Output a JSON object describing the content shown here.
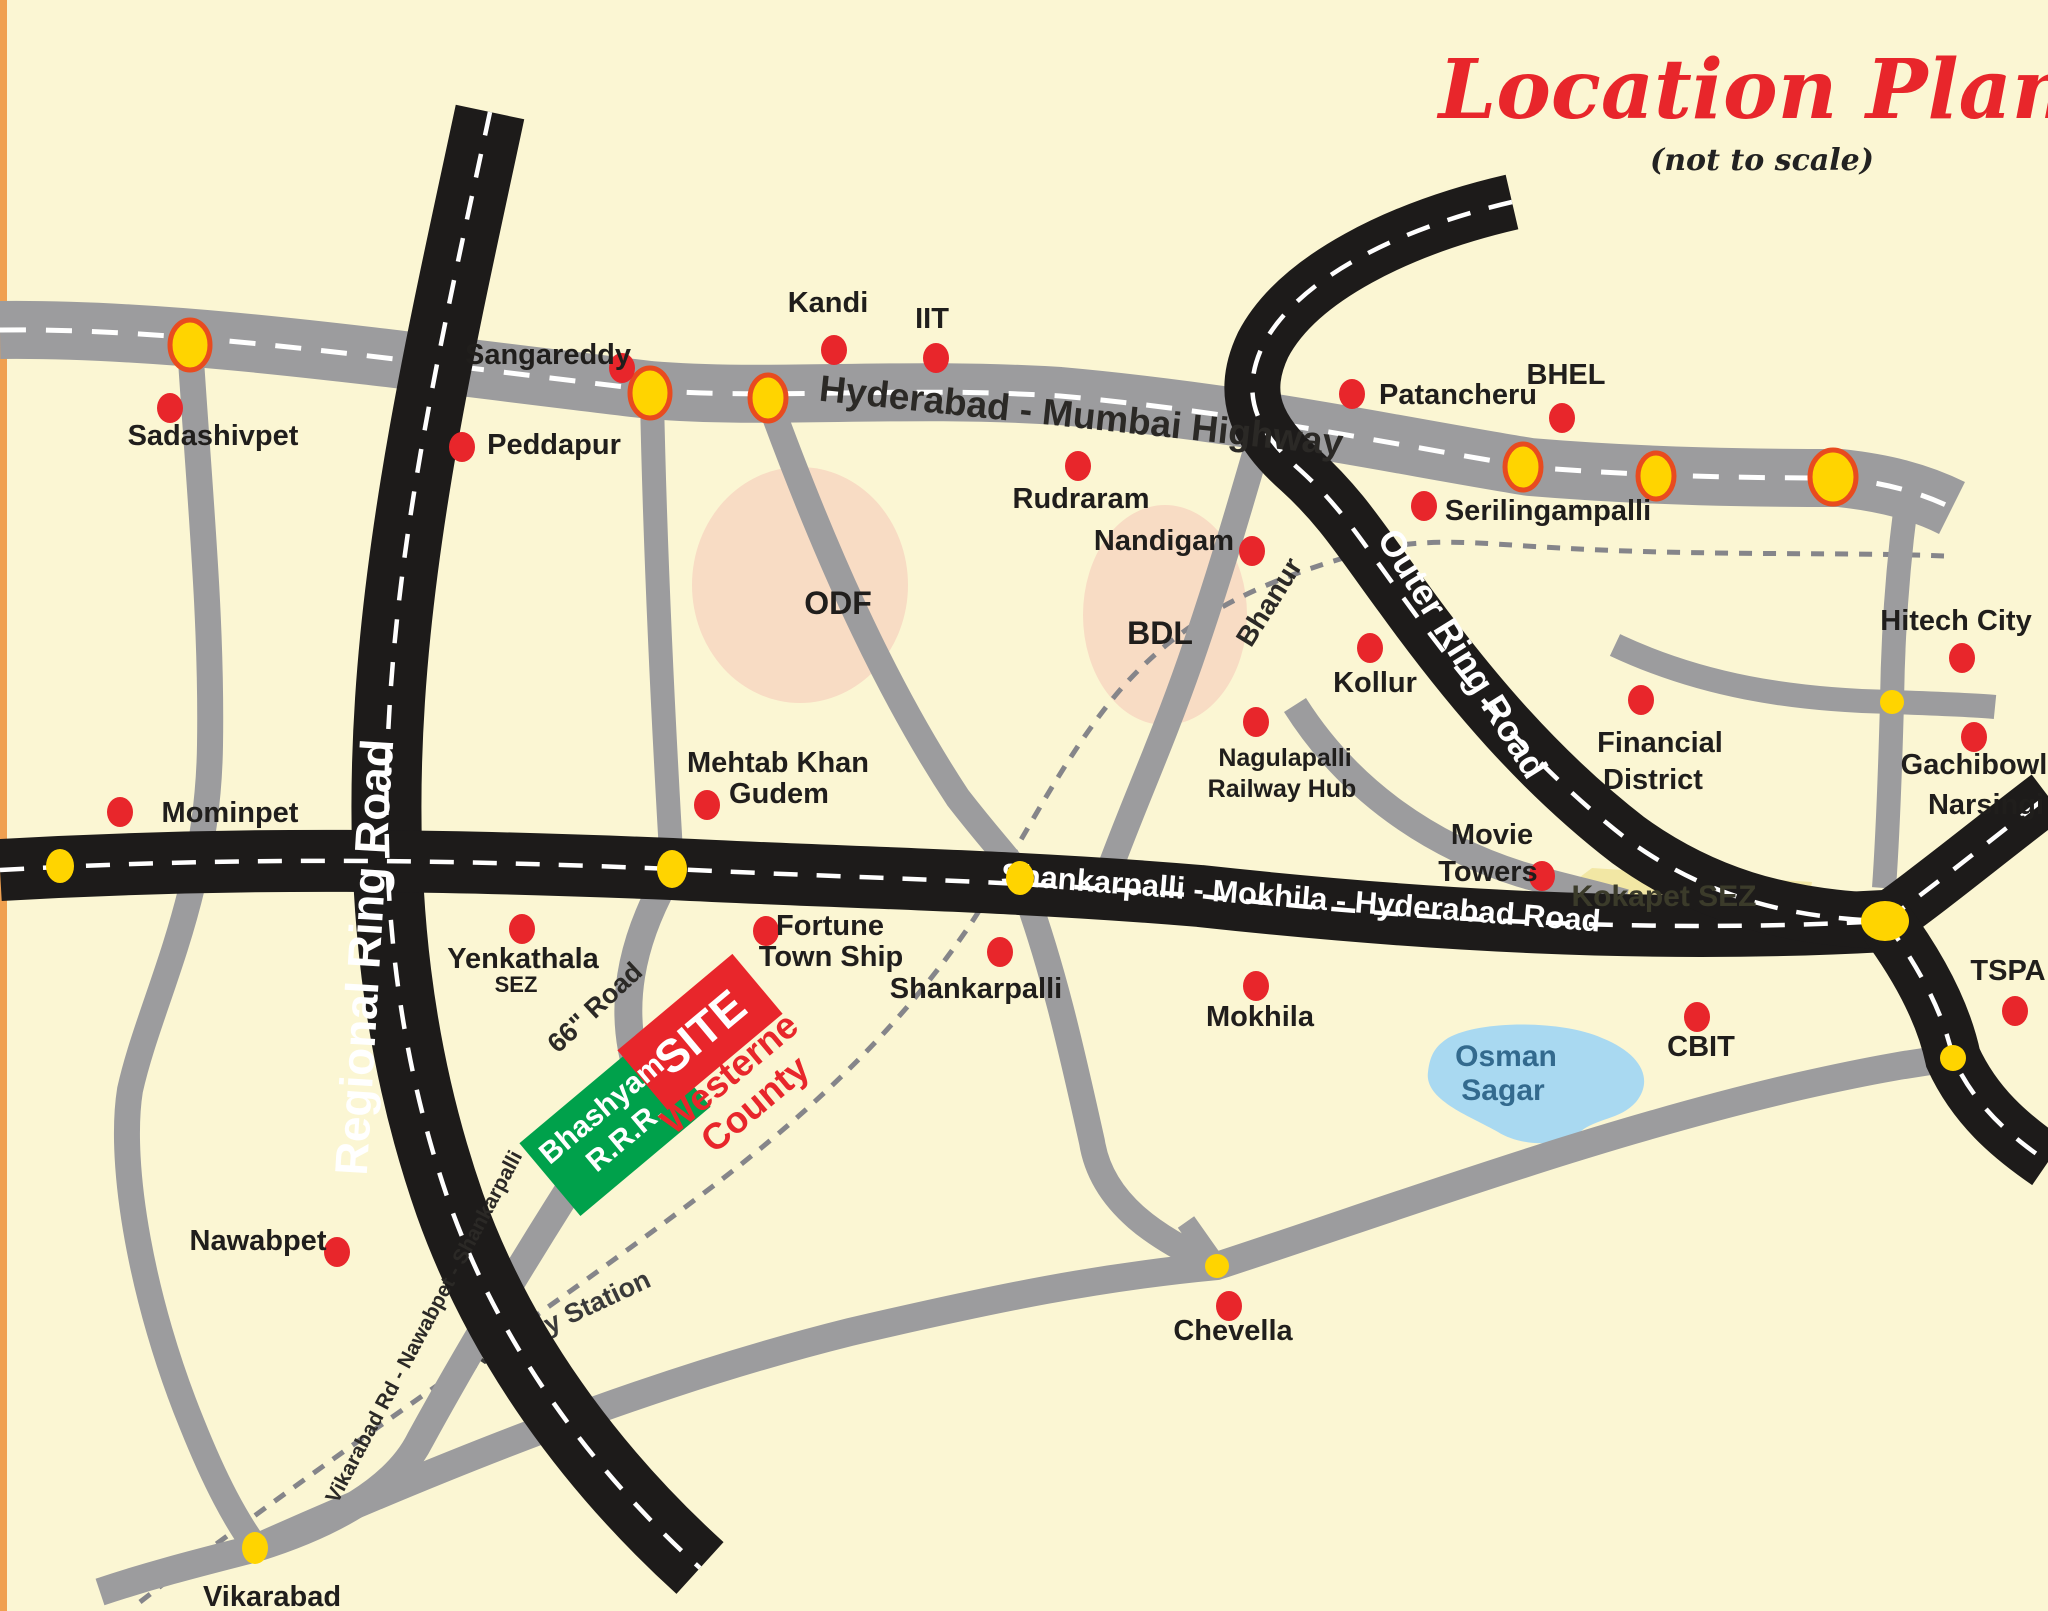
{
  "title": {
    "text": "Location Plan",
    "subtitle": "(not to scale)"
  },
  "colors": {
    "background": "#fbf6d3",
    "left_border": "#f0a050",
    "road_gray": "#9c9c9e",
    "road_black": "#1d1b1a",
    "centerline_dash": "#ffffff",
    "railway_dash": "#85858a",
    "town_dot_red": "#e8262b",
    "junction_yellow": "#ffd400",
    "junction_ring_red": "#e84b1f",
    "factory_zone_pink": "#f8dcc4",
    "kokapet_sez_yellow": "#f2e7a4",
    "lake_blue": "#a9d9f1",
    "lake_text": "#336a8e",
    "site_green": "#00a14b",
    "site_red": "#e8262b",
    "title_red": "#e8262b",
    "label_black": "#201e1c"
  },
  "road_labels": [
    {
      "id": "hyderabad-mumbai-highway",
      "text": "Hyderabad - Mumbai Highway",
      "x": 1080,
      "y": 428,
      "rot": 6,
      "size": 37,
      "color": "#2b2926",
      "layer": "over"
    },
    {
      "id": "regional-ring-road",
      "text": "Regional Ring Road",
      "x": 380,
      "y": 958,
      "rot": -86.5,
      "size": 46,
      "color": "#ffffff",
      "layer": "over"
    },
    {
      "id": "outer-ring-road",
      "text": "Outer Ring Road",
      "x": 1452,
      "y": 660,
      "rot": 58,
      "size": 36,
      "color": "#ffffff",
      "layer": "over"
    },
    {
      "id": "shankarpalli-mokhila-hyderabad-road",
      "text": "Shankarpalli - Mokhila - Hyderabad Road",
      "x": 1300,
      "y": 908,
      "rot": 4.5,
      "size": 31,
      "color": "#ffffff",
      "layer": "over"
    },
    {
      "id": "sixtysix-road",
      "text": "66\" Road",
      "x": 601,
      "y": 1014,
      "rot": -43,
      "size": 27,
      "color": "#2b2926",
      "layer": "over"
    },
    {
      "id": "vikarabad-road",
      "text": "Vikarabad Rd - Nawabpet - Shankarpalli",
      "x": 430,
      "y": 1330,
      "rot": -62,
      "size": 21,
      "color": "#2b2926",
      "layer": "over"
    },
    {
      "id": "railway-station",
      "text": "Railway Station",
      "x": 562,
      "y": 1328,
      "rot": -25,
      "size": 27,
      "color": "#3a3a3a",
      "layer": "under"
    },
    {
      "id": "bhanur",
      "text": "Bhanur",
      "x": 1277,
      "y": 607,
      "rot": -58,
      "size": 28,
      "color": "#2b2926",
      "layer": "over"
    }
  ],
  "towns": [
    {
      "id": "sadashivpet",
      "dot": [
        170,
        408
      ],
      "lines": [
        [
          "Sadashivpet",
          213,
          445
        ]
      ]
    },
    {
      "id": "sangareddy",
      "dot": [
        622,
        368
      ],
      "lines": [
        [
          "Sangareddy",
          548,
          364
        ]
      ]
    },
    {
      "id": "peddapur",
      "dot": [
        462,
        447
      ],
      "lines": [
        [
          "Peddapur",
          554,
          454
        ]
      ]
    },
    {
      "id": "kandi",
      "dot": [
        834,
        350
      ],
      "lines": [
        [
          "Kandi",
          828,
          312
        ]
      ]
    },
    {
      "id": "iit",
      "dot": [
        936,
        358
      ],
      "lines": [
        [
          "IIT",
          932,
          328
        ]
      ]
    },
    {
      "id": "rudraram",
      "dot": [
        1078,
        466
      ],
      "lines": [
        [
          "Rudraram",
          1081,
          508
        ]
      ]
    },
    {
      "id": "nandigam",
      "dot": [
        1252,
        551
      ],
      "lines": [
        [
          "Nandigam",
          1164,
          550
        ]
      ]
    },
    {
      "id": "patancheru",
      "dot": [
        1352,
        394
      ],
      "lines": [
        [
          "Patancheru",
          1458,
          404
        ]
      ]
    },
    {
      "id": "bhel",
      "dot": [
        1562,
        418
      ],
      "lines": [
        [
          "BHEL",
          1566,
          384
        ]
      ]
    },
    {
      "id": "serilingampalli",
      "dot": [
        1424,
        506
      ],
      "lines": [
        [
          "Serilingampalli",
          1548,
          520
        ]
      ]
    },
    {
      "id": "kollur",
      "dot": [
        1370,
        648
      ],
      "lines": [
        [
          "Kollur",
          1375,
          692
        ]
      ]
    },
    {
      "id": "nagulapalli-railway-hub",
      "dot": [
        1256,
        722
      ],
      "size": 25,
      "lines": [
        [
          "Nagulapalli",
          1285,
          766
        ],
        [
          "Railway Hub",
          1282,
          797
        ]
      ]
    },
    {
      "id": "hitech-city",
      "dot": [
        1962,
        658
      ],
      "lines": [
        [
          "Hitech City",
          1956,
          630
        ]
      ]
    },
    {
      "id": "gachibowli",
      "dot": [
        1974,
        737
      ],
      "lines": [
        [
          "Gachibowli",
          1978,
          774
        ]
      ]
    },
    {
      "id": "narsingi",
      "dot": null,
      "lines": [
        [
          "Narsingi",
          1986,
          814
        ]
      ]
    },
    {
      "id": "financial-district",
      "dot": [
        1641,
        700
      ],
      "lines": [
        [
          "Financial",
          1660,
          752
        ],
        [
          "District",
          1653,
          789
        ]
      ]
    },
    {
      "id": "movie-towers",
      "dot": [
        1542,
        876
      ],
      "lines": [
        [
          "Movie",
          1492,
          844
        ],
        [
          "Towers",
          1488,
          881
        ]
      ]
    },
    {
      "id": "mominpet",
      "dot": [
        120,
        812
      ],
      "lines": [
        [
          "Mominpet",
          230,
          822
        ]
      ]
    },
    {
      "id": "mehtab-khan-gudem",
      "dot": [
        707,
        805
      ],
      "lines": [
        [
          "Mehtab Khan",
          778,
          772
        ],
        [
          "Gudem",
          779,
          803
        ]
      ]
    },
    {
      "id": "yenkathala-sez",
      "dot": [
        522,
        929
      ],
      "lines": [
        [
          "Yenkathala",
          523,
          968
        ],
        [
          "SEZ",
          516,
          992,
          22
        ]
      ]
    },
    {
      "id": "fortune-town-ship",
      "dot": [
        766,
        931
      ],
      "lines": [
        [
          "Fortune",
          830,
          935
        ],
        [
          "Town Ship",
          831,
          966
        ]
      ]
    },
    {
      "id": "shankarpalli",
      "dot": [
        1000,
        952
      ],
      "lines": [
        [
          "Shankarpalli",
          976,
          998
        ]
      ]
    },
    {
      "id": "mokhila",
      "dot": [
        1256,
        986
      ],
      "lines": [
        [
          "Mokhila",
          1260,
          1026
        ]
      ]
    },
    {
      "id": "cbit",
      "dot": [
        1697,
        1017
      ],
      "lines": [
        [
          "CBIT",
          1701,
          1056
        ]
      ]
    },
    {
      "id": "tspa",
      "dot": [
        2015,
        1011
      ],
      "lines": [
        [
          "TSPA",
          2008,
          980
        ]
      ]
    },
    {
      "id": "chevella",
      "dot": [
        1229,
        1306
      ],
      "lines": [
        [
          "Chevella",
          1233,
          1340
        ]
      ]
    },
    {
      "id": "nawabpet",
      "dot": [
        337,
        1252
      ],
      "lines": [
        [
          "Nawabpet",
          258,
          1250
        ]
      ]
    },
    {
      "id": "vikarabad",
      "dot": null,
      "lines": [
        [
          "Vikarabad",
          272,
          1606
        ]
      ]
    },
    {
      "id": "odf-area",
      "dot": null,
      "size": 32,
      "lines": [
        [
          "ODF",
          838,
          614
        ]
      ]
    },
    {
      "id": "bdl-area",
      "dot": null,
      "size": 32,
      "lines": [
        [
          "BDL",
          1160,
          644
        ]
      ]
    },
    {
      "id": "kokapet-sez",
      "dot": null,
      "size": 30,
      "color": "#3b3b2a",
      "lines": [
        [
          "Kokapet SEZ",
          1664,
          906
        ]
      ]
    },
    {
      "id": "osman-sagar",
      "dot": null,
      "size": 30,
      "color": "#336a8e",
      "lines": [
        [
          "Osman",
          1506,
          1066
        ],
        [
          "Sagar",
          1503,
          1100
        ]
      ]
    }
  ],
  "junctions": [
    {
      "x": 190,
      "y": 345,
      "rx": 20,
      "ry": 25,
      "ring": true
    },
    {
      "x": 650,
      "y": 393,
      "rx": 20,
      "ry": 25,
      "ring": true
    },
    {
      "x": 768,
      "y": 398,
      "rx": 18,
      "ry": 23,
      "ring": true
    },
    {
      "x": 1523,
      "y": 467,
      "rx": 18,
      "ry": 23,
      "ring": true
    },
    {
      "x": 1656,
      "y": 476,
      "rx": 18,
      "ry": 23,
      "ring": true
    },
    {
      "x": 1833,
      "y": 477,
      "rx": 23,
      "ry": 27,
      "ring": true
    },
    {
      "x": 60,
      "y": 866,
      "rx": 14,
      "ry": 17,
      "ring": false
    },
    {
      "x": 672,
      "y": 869,
      "rx": 15,
      "ry": 19,
      "ring": false
    },
    {
      "x": 1020,
      "y": 878,
      "rx": 14,
      "ry": 17,
      "ring": false
    },
    {
      "x": 1885,
      "y": 921,
      "rx": 24,
      "ry": 20,
      "ring": false
    },
    {
      "x": 1892,
      "y": 702,
      "rx": 12,
      "ry": 12,
      "ring": false
    },
    {
      "x": 1953,
      "y": 1058,
      "rx": 13,
      "ry": 13,
      "ring": false
    },
    {
      "x": 1217,
      "y": 1266,
      "rx": 12,
      "ry": 12,
      "ring": false
    },
    {
      "x": 255,
      "y": 1548,
      "rx": 13,
      "ry": 16,
      "ring": false
    }
  ],
  "site": {
    "label": "SITE",
    "developer_line1": "Bhashyam",
    "developer_line2": "R.R.R.",
    "county_line1": "Westerne",
    "county_line2": "County"
  }
}
